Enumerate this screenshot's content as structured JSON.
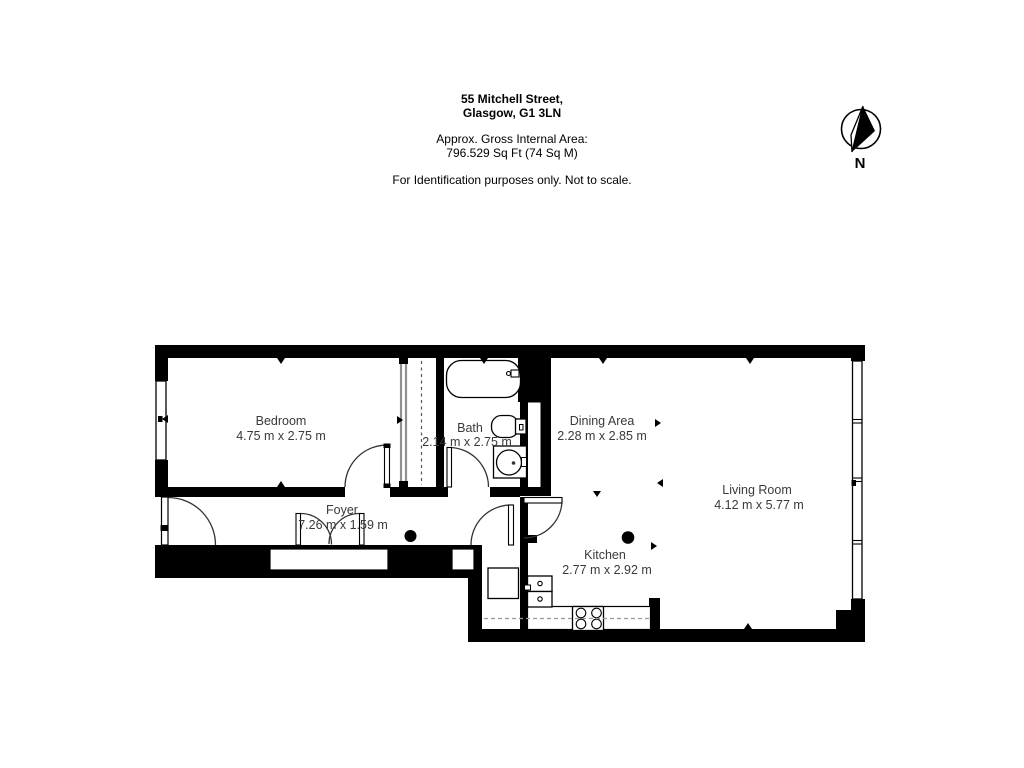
{
  "header": {
    "address_line1": "55 Mitchell Street,",
    "address_line2": "Glasgow, G1 3LN",
    "area_label": "Approx. Gross Internal Area:",
    "area_value": "796.529 Sq Ft (74 Sq M)",
    "disclaimer": "For Identification purposes only. Not to scale."
  },
  "compass": {
    "label": "N"
  },
  "rooms": {
    "bedroom": {
      "name": "Bedroom",
      "dims": "4.75 m x 2.75 m"
    },
    "bath": {
      "name": "Bath",
      "dims": "2.14 m x 2.75 m"
    },
    "dining": {
      "name": "Dining Area",
      "dims": "2.28 m x 2.85 m"
    },
    "living": {
      "name": "Living Room",
      "dims": "4.12 m x 5.77 m"
    },
    "foyer": {
      "name": "Foyer",
      "dims": "7.26 m x 1.59 m"
    },
    "kitchen": {
      "name": "Kitchen",
      "dims": "2.77 m x 2.92 m"
    }
  },
  "colors": {
    "wall": "#000000",
    "room_label": "#3a3a3a",
    "background": "#ffffff",
    "sliding_door": "#909090"
  }
}
